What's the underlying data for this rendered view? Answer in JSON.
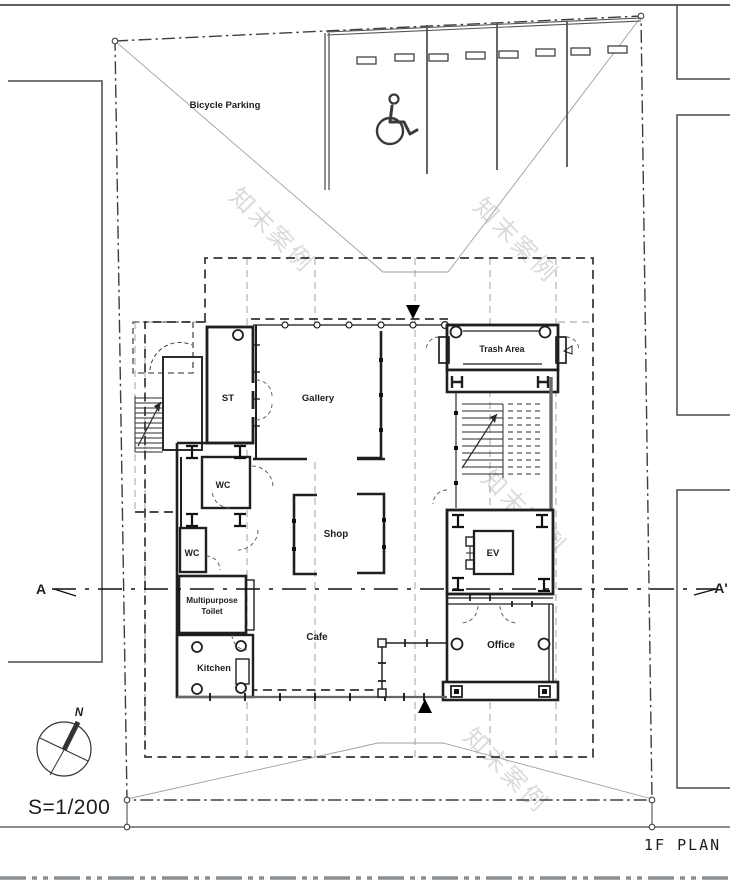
{
  "page": {
    "title": "1F PLAN",
    "scale_label": "S=1/200",
    "ink_color": "#2e2e2e",
    "gray_color": "#8b9094"
  },
  "compass": {
    "north_label": "N",
    "icon": "north-arrow-icon"
  },
  "section": {
    "left_label": "A",
    "right_label": "A'"
  },
  "site": {
    "bicycle_parking_label": "Bicycle Parking",
    "parking_stall_count": 4,
    "accessible_icon": "wheelchair-icon",
    "north_entrance_icon": "entrance-arrow-down-icon",
    "south_entrance_icon": "entrance-arrow-up-icon"
  },
  "rooms": {
    "st": "ST",
    "gallery": "Gallery",
    "trash_area": "Trash Area",
    "wc_upper": "WC",
    "wc_lower": "WC",
    "shop": "Shop",
    "ev": "EV",
    "multipurpose_toilet_line1": "Multipurpose",
    "multipurpose_toilet_line2": "Toilet",
    "cafe": "Cafe",
    "kitchen": "Kitchen",
    "office": "Office"
  },
  "watermark": {
    "text": "知末案例"
  }
}
